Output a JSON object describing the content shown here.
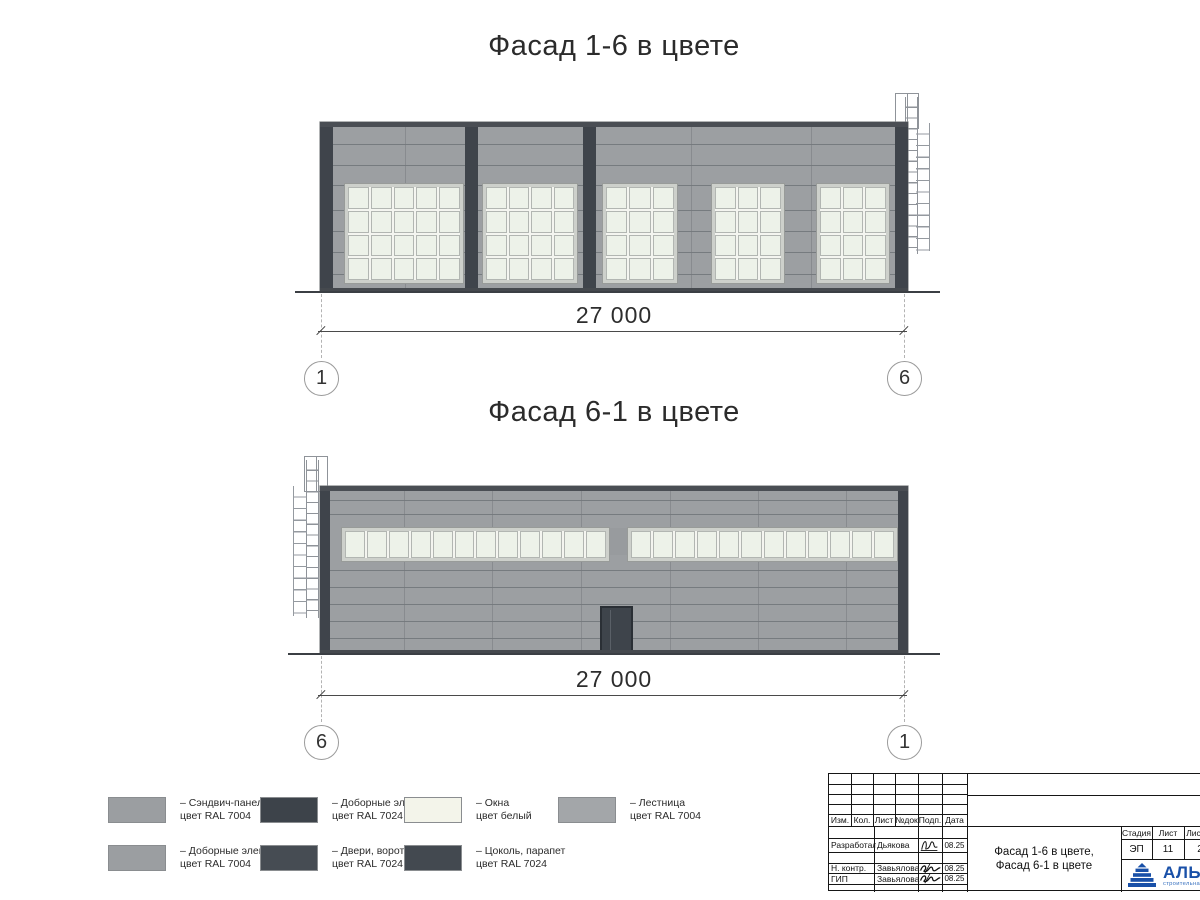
{
  "titles": {
    "facade16": "Фасад 1-6 в цвете",
    "facade61": "Фасад 6-1 в цвете"
  },
  "dim1": {
    "value": "27 000",
    "axis_left": "1",
    "axis_right": "6"
  },
  "dim2": {
    "value": "27 000",
    "axis_left": "6",
    "axis_right": "1"
  },
  "legend": {
    "items": [
      {
        "line1": "– Сэндвич-панели",
        "line2": "цвет RAL 7004",
        "color": "#9b9ea1"
      },
      {
        "line1": "– Доборные элементы",
        "line2": "цвет RAL 7024",
        "color": "#3d434a"
      },
      {
        "line1": "– Окна",
        "line2": "цвет белый",
        "color": "#f3f4ea"
      },
      {
        "line1": "– Лестница",
        "line2": "цвет RAL 7004",
        "color": "#a3a6a9"
      },
      {
        "line1": "– Доборные элементы",
        "line2": "цвет RAL 7004",
        "color": "#9b9ea1"
      },
      {
        "line1": "– Двери, ворота",
        "line2": "цвет RAL 7024",
        "color": "#464c53"
      },
      {
        "line1": "– Цоколь, парапет",
        "line2": "цвет RAL 7024",
        "color": "#434950"
      }
    ]
  },
  "title_block": {
    "cols": [
      "Изм.",
      "Кол.",
      "Лист",
      "№док",
      "Подп.",
      "Дата"
    ],
    "rows": [
      {
        "role": "Разработал",
        "name": "Дьякова",
        "date": "08.25"
      },
      {
        "role": "Н. контр.",
        "name": "Завьялова",
        "date": "08.25"
      },
      {
        "role": "ГИП",
        "name": "Завьялова",
        "date": "08.25"
      }
    ],
    "doc_title1": "Фасад 1-6 в цвете,",
    "doc_title2": "Фасад 6-1 в цвете",
    "stage_label": "Стадия",
    "sheet_label": "Лист",
    "sheets_label": "Листов",
    "stage_value": "ЭП",
    "sheet_value": "11",
    "sheets_value": "2",
    "logo_text": "АЛЬЯНС",
    "logo_sub": "строительная компания"
  },
  "colors": {
    "ral7004": "#9b9ea1",
    "ral7024": "#3f454c",
    "window_white": "#eef3ea",
    "logo_blue": "#1950a8"
  }
}
